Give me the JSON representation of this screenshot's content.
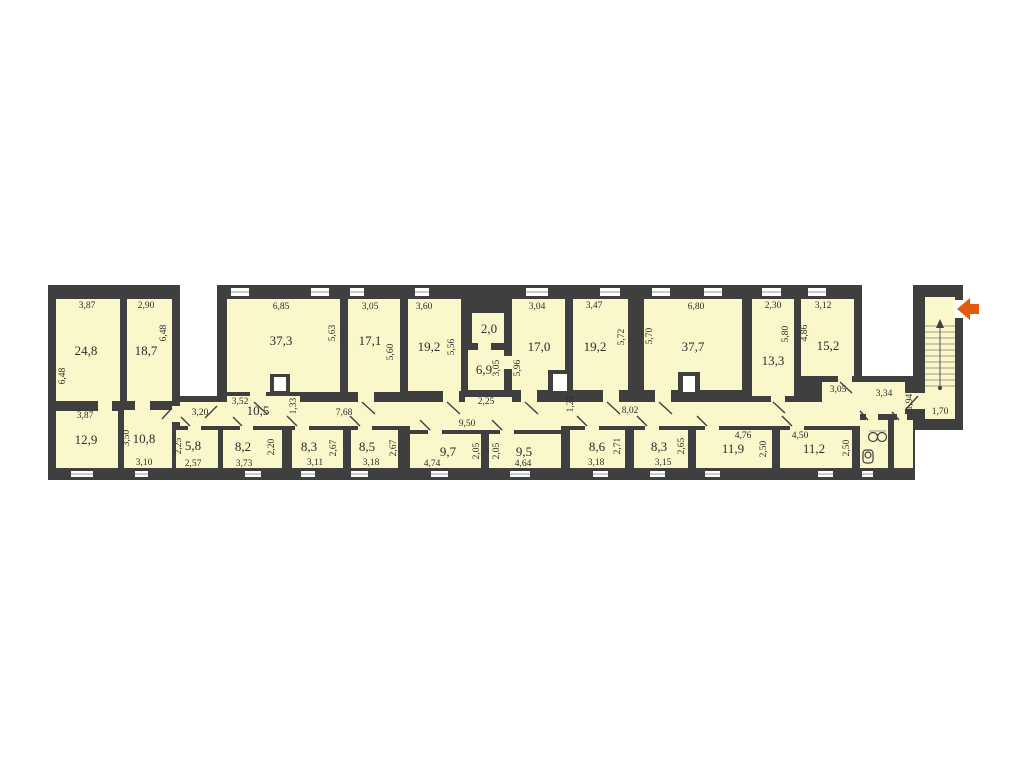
{
  "colors": {
    "wall": "#3f3f3f",
    "room_fill": "#faf8ca",
    "background": "#ffffff",
    "text": "#2b2b2b",
    "entrance_arrow": "#e55a0c"
  },
  "area_labels": [
    {
      "t": "24,8",
      "x": 86,
      "y": 352
    },
    {
      "t": "18,7",
      "x": 146,
      "y": 352
    },
    {
      "t": "12,9",
      "x": 86,
      "y": 441
    },
    {
      "t": "10,8",
      "x": 144,
      "y": 440
    },
    {
      "t": "5,8",
      "x": 193,
      "y": 447
    },
    {
      "t": "8,2",
      "x": 243,
      "y": 448
    },
    {
      "t": "10,5",
      "x": 258,
      "y": 412
    },
    {
      "t": "37,3",
      "x": 281,
      "y": 342
    },
    {
      "t": "17,1",
      "x": 370,
      "y": 342
    },
    {
      "t": "19,2",
      "x": 429,
      "y": 348
    },
    {
      "t": "2,0",
      "x": 489,
      "y": 330
    },
    {
      "t": "6,9",
      "x": 484,
      "y": 371
    },
    {
      "t": "17,0",
      "x": 539,
      "y": 348
    },
    {
      "t": "19,2",
      "x": 595,
      "y": 348
    },
    {
      "t": "37,7",
      "x": 693,
      "y": 348
    },
    {
      "t": "13,3",
      "x": 773,
      "y": 362
    },
    {
      "t": "15,2",
      "x": 828,
      "y": 347
    },
    {
      "t": "8,3",
      "x": 309,
      "y": 448
    },
    {
      "t": "8,5",
      "x": 367,
      "y": 448
    },
    {
      "t": "9,7",
      "x": 448,
      "y": 453
    },
    {
      "t": "9,5",
      "x": 524,
      "y": 453
    },
    {
      "t": "8,6",
      "x": 597,
      "y": 448
    },
    {
      "t": "8,3",
      "x": 659,
      "y": 448
    },
    {
      "t": "11,9",
      "x": 733,
      "y": 450
    },
    {
      "t": "11,2",
      "x": 814,
      "y": 450
    }
  ],
  "dim_labels": [
    {
      "t": "3,87",
      "x": 87,
      "y": 306
    },
    {
      "t": "2,90",
      "x": 146,
      "y": 306
    },
    {
      "t": "6,48",
      "x": 164,
      "y": 333,
      "v": true
    },
    {
      "t": "6,48",
      "x": 63,
      "y": 376,
      "v": true
    },
    {
      "t": "3,87",
      "x": 85,
      "y": 416
    },
    {
      "t": "3,50",
      "x": 127,
      "y": 438,
      "v": true
    },
    {
      "t": "3,10",
      "x": 144,
      "y": 463
    },
    {
      "t": "2,25",
      "x": 179,
      "y": 446,
      "v": true
    },
    {
      "t": "2,57",
      "x": 193,
      "y": 464
    },
    {
      "t": "3,73",
      "x": 244,
      "y": 464
    },
    {
      "t": "2,20",
      "x": 272,
      "y": 447,
      "v": true
    },
    {
      "t": "3,20",
      "x": 200,
      "y": 413
    },
    {
      "t": "3,52",
      "x": 240,
      "y": 402
    },
    {
      "t": "1,33",
      "x": 294,
      "y": 406,
      "v": true
    },
    {
      "t": "7,68",
      "x": 344,
      "y": 413
    },
    {
      "t": "6,85",
      "x": 281,
      "y": 307
    },
    {
      "t": "5,63",
      "x": 333,
      "y": 333,
      "v": true
    },
    {
      "t": "3,05",
      "x": 370,
      "y": 307
    },
    {
      "t": "5,60",
      "x": 391,
      "y": 352,
      "v": true
    },
    {
      "t": "3,60",
      "x": 424,
      "y": 307
    },
    {
      "t": "5,56",
      "x": 452,
      "y": 347,
      "v": true
    },
    {
      "t": "3,05",
      "x": 497,
      "y": 368,
      "v": true
    },
    {
      "t": "5,96",
      "x": 518,
      "y": 368,
      "v": true
    },
    {
      "t": "2,25",
      "x": 486,
      "y": 402
    },
    {
      "t": "3,04",
      "x": 537,
      "y": 307
    },
    {
      "t": "3,47",
      "x": 594,
      "y": 306
    },
    {
      "t": "5,72",
      "x": 622,
      "y": 337,
      "v": true
    },
    {
      "t": "5,70",
      "x": 650,
      "y": 336,
      "v": true
    },
    {
      "t": "6,80",
      "x": 696,
      "y": 307
    },
    {
      "t": "2,30",
      "x": 773,
      "y": 306
    },
    {
      "t": "5,80",
      "x": 786,
      "y": 334,
      "v": true
    },
    {
      "t": "3,12",
      "x": 823,
      "y": 306
    },
    {
      "t": "4,86",
      "x": 805,
      "y": 333,
      "v": true
    },
    {
      "t": "3,05",
      "x": 838,
      "y": 390
    },
    {
      "t": "3,34",
      "x": 884,
      "y": 394
    },
    {
      "t": "1,94",
      "x": 910,
      "y": 402,
      "v": true
    },
    {
      "t": "1,70",
      "x": 940,
      "y": 412
    },
    {
      "t": "9,50",
      "x": 467,
      "y": 424
    },
    {
      "t": "1,22",
      "x": 571,
      "y": 404,
      "v": true
    },
    {
      "t": "8,02",
      "x": 630,
      "y": 411
    },
    {
      "t": "3,11",
      "x": 315,
      "y": 463
    },
    {
      "t": "2,67",
      "x": 334,
      "y": 448,
      "v": true
    },
    {
      "t": "3,18",
      "x": 371,
      "y": 463
    },
    {
      "t": "2,67",
      "x": 394,
      "y": 448,
      "v": true
    },
    {
      "t": "4,74",
      "x": 432,
      "y": 464
    },
    {
      "t": "2,05",
      "x": 477,
      "y": 451,
      "v": true
    },
    {
      "t": "2,05",
      "x": 497,
      "y": 451,
      "v": true
    },
    {
      "t": "4,64",
      "x": 523,
      "y": 464
    },
    {
      "t": "3,18",
      "x": 596,
      "y": 463
    },
    {
      "t": "2,71",
      "x": 618,
      "y": 446,
      "v": true
    },
    {
      "t": "3,15",
      "x": 663,
      "y": 463
    },
    {
      "t": "2,65",
      "x": 682,
      "y": 446,
      "v": true
    },
    {
      "t": "4,76",
      "x": 743,
      "y": 436
    },
    {
      "t": "2,50",
      "x": 764,
      "y": 449,
      "v": true
    },
    {
      "t": "4,50",
      "x": 800,
      "y": 436
    },
    {
      "t": "2,50",
      "x": 847,
      "y": 448,
      "v": true
    }
  ]
}
